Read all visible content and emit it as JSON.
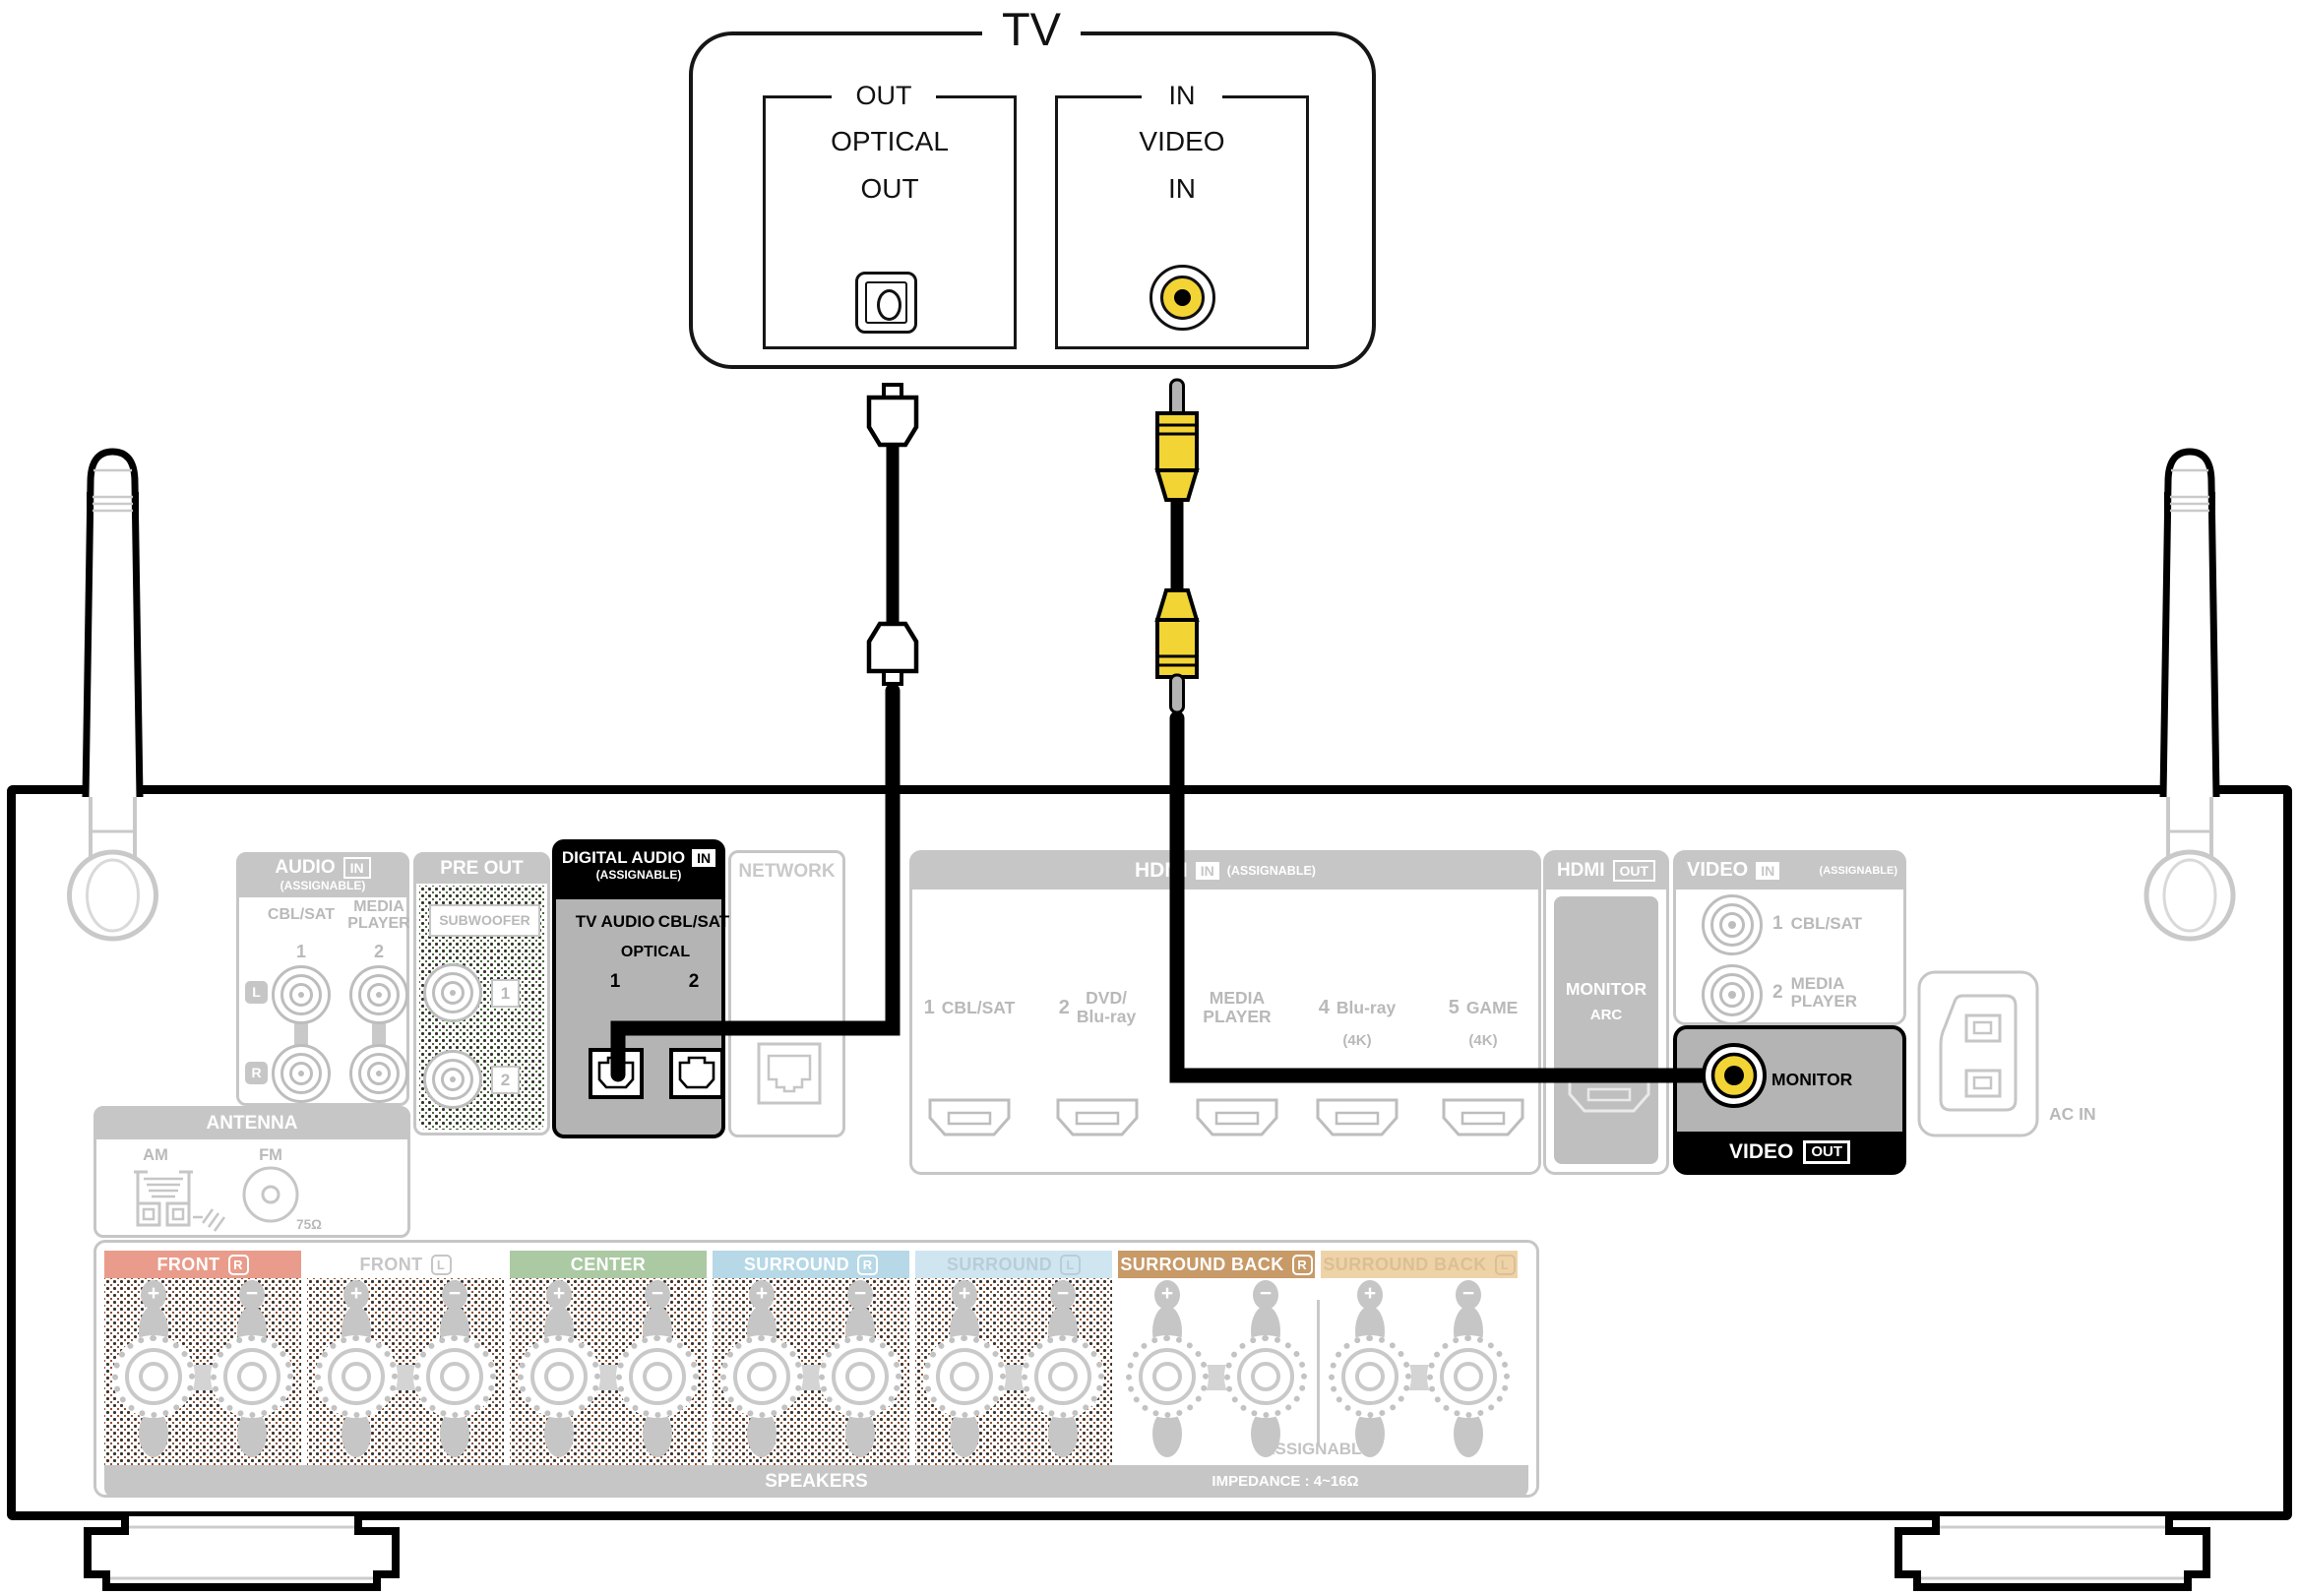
{
  "tv": {
    "title": "TV",
    "optical_port": {
      "group": "OUT",
      "line1": "OPTICAL",
      "line2": "OUT"
    },
    "video_port": {
      "group": "IN",
      "line1": "VIDEO",
      "line2": "IN"
    }
  },
  "receiver": {
    "audio_in": {
      "title": "AUDIO",
      "badge": "IN",
      "note": "(ASSIGNABLE)",
      "col1": "CBL/SAT",
      "col2_line1": "MEDIA",
      "col2_line2": "PLAYER",
      "num1": "1",
      "num2": "2",
      "left": "L",
      "right": "R"
    },
    "pre_out": {
      "title": "PRE OUT",
      "label": "SUBWOOFER",
      "num1": "1",
      "num2": "2"
    },
    "digital_audio_in": {
      "title": "DIGITAL AUDIO",
      "badge": "IN",
      "note": "(ASSIGNABLE)",
      "jack1": "TV AUDIO",
      "jack2": "CBL/SAT",
      "type": "OPTICAL",
      "num1": "1",
      "num2": "2"
    },
    "network": {
      "title": "NETWORK"
    },
    "hdmi_in": {
      "title": "HDMI",
      "badge": "IN",
      "note": "(ASSIGNABLE)",
      "ports": [
        {
          "num": "1",
          "line1": "CBL/SAT",
          "line2": "",
          "sub": ""
        },
        {
          "num": "2",
          "line1": "DVD/",
          "line2": "Blu-ray",
          "sub": ""
        },
        {
          "num": "",
          "line1": "MEDIA",
          "line2": "PLAYER",
          "sub": ""
        },
        {
          "num": "4",
          "line1": "Blu-ray",
          "line2": "",
          "sub": "(4K)"
        },
        {
          "num": "5",
          "line1": "GAME",
          "line2": "",
          "sub": "(4K)"
        }
      ]
    },
    "hdmi_out": {
      "title": "HDMI",
      "badge": "OUT",
      "line1": "MONITOR",
      "line2": "ARC"
    },
    "video_in": {
      "title": "VIDEO",
      "badge": "IN",
      "note": "(ASSIGNABLE)",
      "port1_num": "1",
      "port1_label": "CBL/SAT",
      "port2_num": "2",
      "port2_line1": "MEDIA",
      "port2_line2": "PLAYER"
    },
    "monitor_out": {
      "jack_label": "MONITOR",
      "title": "VIDEO",
      "badge": "OUT"
    },
    "ac_in": {
      "label": "AC IN"
    },
    "antenna": {
      "title": "ANTENNA",
      "am": "AM",
      "fm": "FM",
      "fm_impedance": "75Ω"
    },
    "speakers": {
      "channels": [
        {
          "label": "FRONT",
          "badge": "R",
          "bg": "#e99c8b",
          "fg": "#ffffff"
        },
        {
          "label": "FRONT",
          "badge": "L",
          "bg": "transparent",
          "fg": "#c6c6c6"
        },
        {
          "label": "CENTER",
          "badge": "",
          "bg": "#abc9a2",
          "fg": "#ffffff"
        },
        {
          "label": "SURROUND",
          "badge": "R",
          "bg": "#b6d8e7",
          "fg": "#ffffff"
        },
        {
          "label": "SURROUND",
          "badge": "L",
          "bg": "#cfe6f0",
          "fg": "#b9cdd8"
        },
        {
          "label": "SURROUND BACK",
          "badge": "R",
          "bg": "#c79a68",
          "fg": "#ffffff"
        },
        {
          "label": "SURROUND BACK",
          "badge": "L",
          "bg": "#eed3a9",
          "fg": "#dcbf94"
        }
      ],
      "plus": "+",
      "minus": "−",
      "assignable": "ASSIGNABLE",
      "bar_label": "SPEAKERS",
      "impedance": "IMPEDANCE : 4~16Ω"
    }
  },
  "colors": {
    "cable": "#000000",
    "video_rca_yellow": "#f2d435",
    "grayed": "#b9b9b9",
    "header_strip": "#c6c6c6",
    "highlight_body": "#b4b4b4",
    "black": "#000000"
  }
}
